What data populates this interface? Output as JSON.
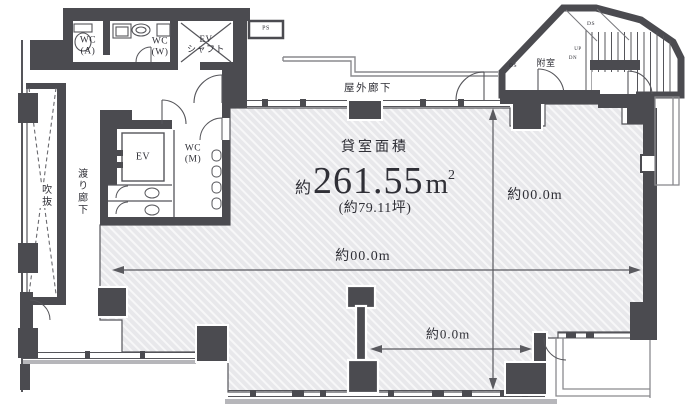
{
  "colors": {
    "wall": "#4b4b50",
    "room_fill": "#e8e8eb",
    "hatch_stripe": "#f7f7f8",
    "thin_line": "#55555a",
    "dimension_line": "#5a5a5f",
    "text": "#2f2f36"
  },
  "area": {
    "title": "貸室面積",
    "prefix": "約",
    "value": "261.55",
    "unit": "m",
    "unit_sup": "2",
    "tsubo": "(約79.11坪)"
  },
  "dimensions": {
    "width": "約00.0m",
    "height": "約00.0m",
    "partial": "約0.0m"
  },
  "rooms": {
    "outdoor_corridor": "屋外廊下",
    "vestibule": "附室",
    "void_space": "吹抜",
    "bridge_corridor": "渡り廊下",
    "wc_a": "WC\n(A)",
    "wc_w": "WC\n(W)",
    "wc_m": "WC\n(M)",
    "elevator": "EV",
    "ev_shaft": "EV\nシャフト",
    "pipe_space": "PS",
    "duct_space": "DS",
    "stair_up": "UP",
    "stair_down": "DN"
  }
}
